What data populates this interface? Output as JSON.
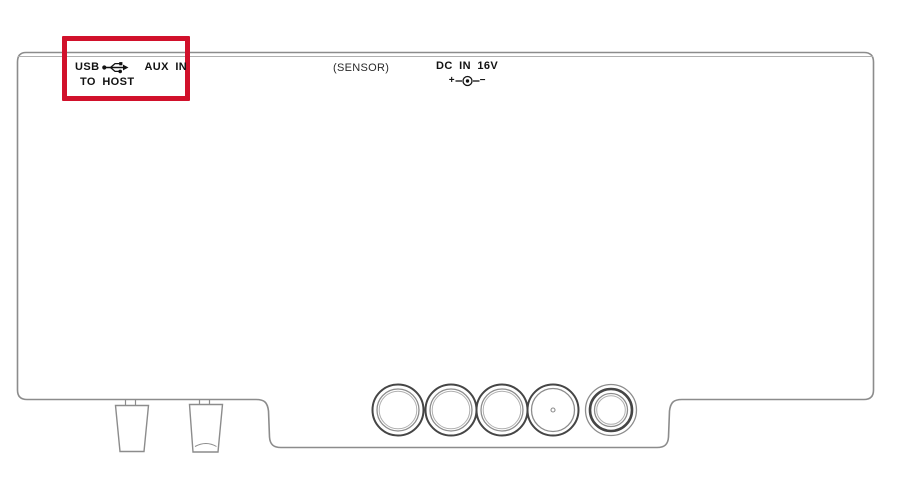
{
  "diagram": {
    "type": "device-rear-panel-line-drawing",
    "labels": {
      "usb": "USB",
      "to_host": "TO HOST",
      "aux_in": "AUX IN",
      "sensor": "(SENSOR)",
      "dc_in": "DC IN 16V",
      "polarity_plus": "+",
      "polarity_minus": "−"
    },
    "icons": {
      "usb": "usb-trident-icon",
      "polarity": "dc-polarity-center-positive-icon"
    },
    "colors": {
      "highlight_red": "#d1112b",
      "line_gray": "#8c8c8c",
      "line_light": "#b0b0b0",
      "line_dark": "#454545",
      "text_black": "#121212",
      "background": "#ffffff"
    },
    "connectors": {
      "round_jacks": 5,
      "feet": 2
    }
  }
}
